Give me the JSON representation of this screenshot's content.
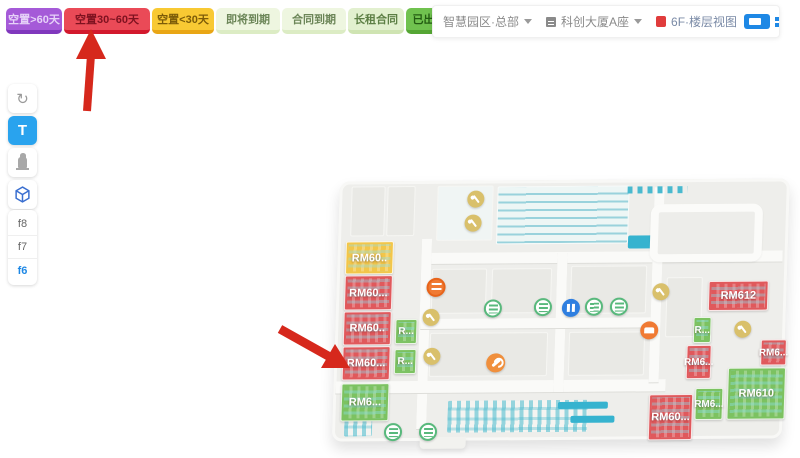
{
  "legend": {
    "buttons": [
      {
        "id": "vacant-60plus",
        "label": "空置>60天",
        "color": "#a55ad8"
      },
      {
        "id": "vacant-30-60",
        "label": "空置30~60天",
        "color": "#ea4a57"
      },
      {
        "id": "vacant-under-30",
        "label": "空置<30天",
        "color": "#f8c933"
      },
      {
        "id": "expiring-soon",
        "label": "即将到期",
        "color": "#eef6e0"
      },
      {
        "id": "contract-expire",
        "label": "合同到期",
        "color": "#eef6e0"
      },
      {
        "id": "long-lease",
        "label": "长租合同",
        "color": "#e2f0cf"
      },
      {
        "id": "leased",
        "label": "已出租",
        "color": "#70c24f"
      }
    ]
  },
  "toolbar": {
    "park_select": {
      "label": "智慧园区·总部"
    },
    "building_select": {
      "label": "科创大厦A座"
    },
    "floor_link": {
      "label": "6F·楼层视图"
    }
  },
  "sidebar": {
    "text_tool_label": "T",
    "floors": [
      {
        "label": "f8",
        "active": false
      },
      {
        "label": "f7",
        "active": false
      },
      {
        "label": "f6",
        "active": true
      }
    ]
  },
  "map": {
    "rooms": [
      {
        "label": "RM60..",
        "status": "vacant-under-30"
      },
      {
        "label": "RM60...",
        "status": "vacant-30-60"
      },
      {
        "label": "RM60..",
        "status": "vacant-30-60"
      },
      {
        "label": "RM60...",
        "status": "vacant-30-60"
      },
      {
        "label": "RM6...",
        "status": "leased"
      },
      {
        "label": "R...",
        "status": "leased"
      },
      {
        "label": "R...",
        "status": "leased"
      },
      {
        "label": "RM612",
        "status": "vacant-30-60"
      },
      {
        "label": "R...",
        "status": "leased"
      },
      {
        "label": "RM6...",
        "status": "vacant-30-60"
      },
      {
        "label": "RM6...",
        "status": "vacant-30-60"
      },
      {
        "label": "RM610",
        "status": "leased"
      },
      {
        "label": "RM6...",
        "status": "leased"
      },
      {
        "label": "RM60...",
        "status": "vacant-30-60"
      }
    ],
    "status_colors": {
      "vacant-30-60": "#e0595c",
      "vacant-under-30": "#f2c64a",
      "leased": "#7cc261"
    }
  }
}
